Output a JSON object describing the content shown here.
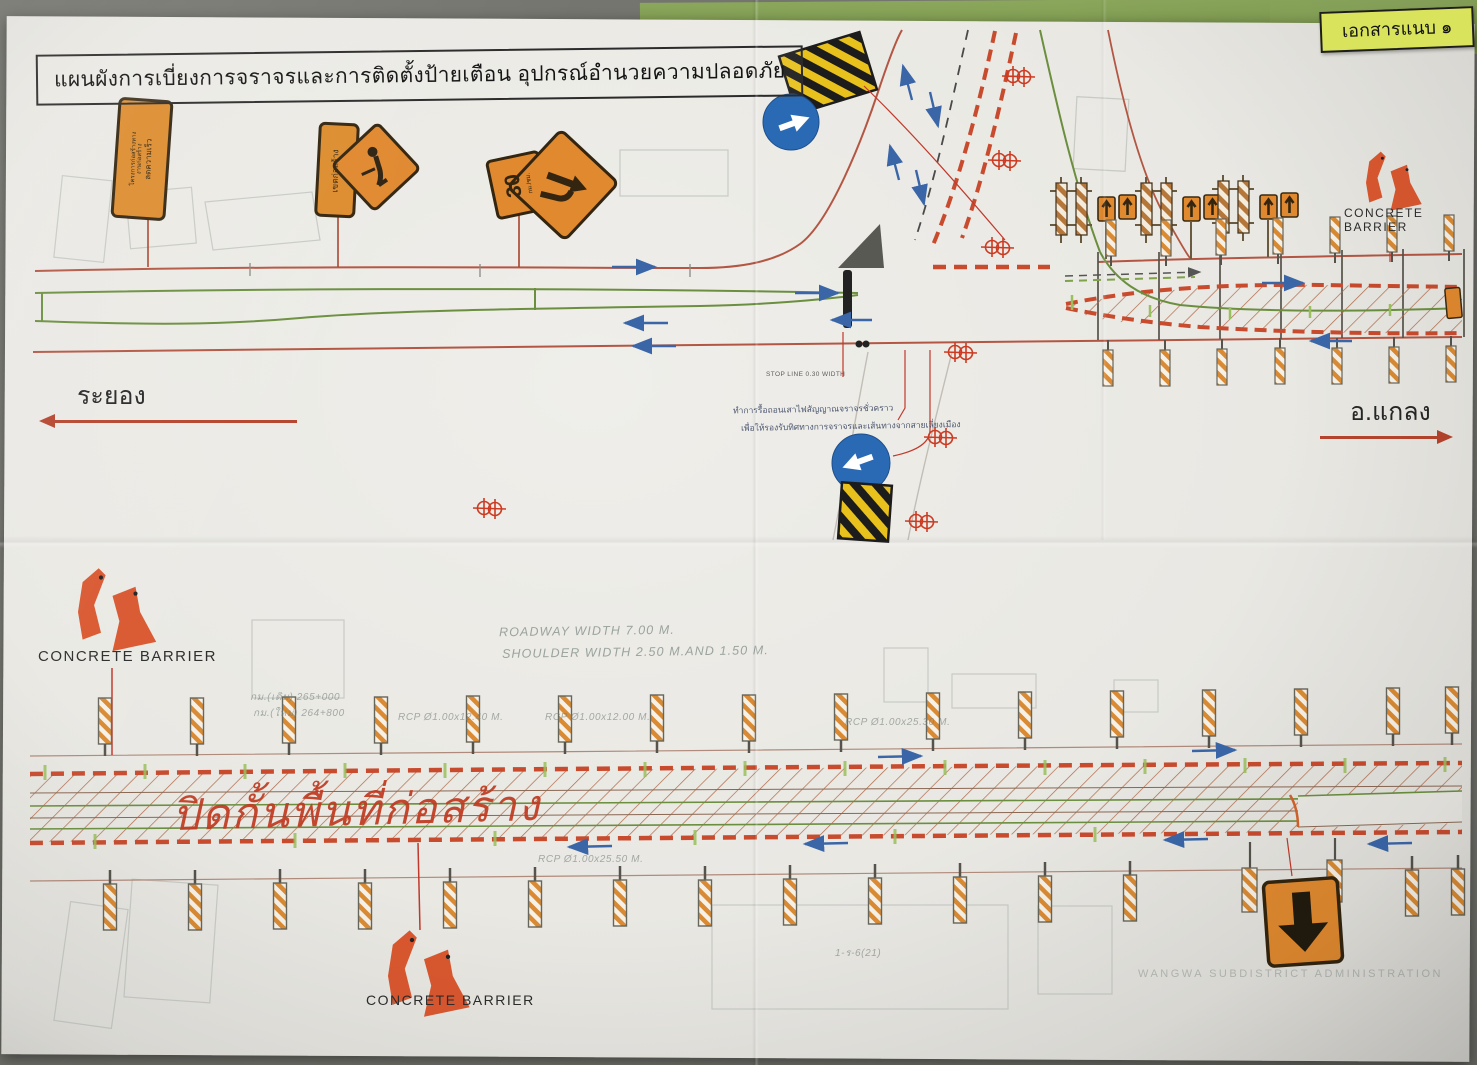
{
  "attachment_label": "เอกสารแนบ ๑",
  "title": "แผนผังการเบี่ยงการจราจรและการติดตั้งป้ายเตือน อุปกรณ์อำนวยความปลอดภัย",
  "directions": {
    "west": "ระยอง",
    "east": "อ.แกลง"
  },
  "labels": {
    "concrete_barrier": "CONCRETE BARRIER",
    "stop_line": "STOP LINE 0.30 WIDTH",
    "construction_zone": "ปิดกั้นพื้นที่ก่อสร้าง",
    "roadway_width": "ROADWAY WIDTH 7.00 M.",
    "shoulder_width": "SHOULDER WIDTH 2.50 M.AND 1.50 M.",
    "note_line1": "ทำการรื้อถอนเสาไฟสัญญาณจราจรชั่วคราว",
    "note_line2": "เพื่อให้รองรับทิศทางการจราจรและเส้นทางจากสายเลี่ยงเมือง",
    "watermark": "WANGWA SUBDISTRICT ADMINISTRATION"
  },
  "signs": {
    "project_sign_line1": "โครงการก่อสร้างทาง",
    "project_sign_line2": "งานก่อสร้าง",
    "project_sign_line3": "ลดความเร็ว",
    "zone_sign": "เขตก่อสร้าง",
    "speed_value": "30",
    "speed_unit": "กม./ชม."
  },
  "icons": {
    "blue_circle_1": "mandatory-arrow-up-right",
    "blue_circle_2": "mandatory-arrow-down-left",
    "hazard_boards": "yellow-black-striped-barrier",
    "worker_diamond": "men-at-work-warning",
    "merge_diamond": "lane-merge-warning",
    "down_arrow_sign": "orange-down-arrow-sign",
    "delineators": "orange-white-striped-delineator",
    "barricades": "type-iii-barricade-with-arrow-signs",
    "survey_marker": "red-survey-cross-circles",
    "concrete_barrier_icon": "red-concrete-barrier-shapes"
  },
  "faint_annotations": [
    "กม.(เดิม) 265+000",
    "กม.(ใหม่) 264+800",
    "RCP Ø1.00x12.40 M.",
    "RCP Ø1.00x12.00 M.",
    "RCP Ø1.00x25.30 M.",
    "RCP Ø1.00x25.50 M.",
    "1-ร-6(21)"
  ],
  "colors": {
    "paper": "#e9e8e3",
    "accent_red": "#c84b2e",
    "line_green": "#6b8f3f",
    "sign_orange": "#e0892f",
    "stripe_yellow": "#e8c11c",
    "sign_blue": "#2a6ab5",
    "label_green": "#d9e45c",
    "background_green": "#85a356",
    "background_gray": "#75756f"
  }
}
